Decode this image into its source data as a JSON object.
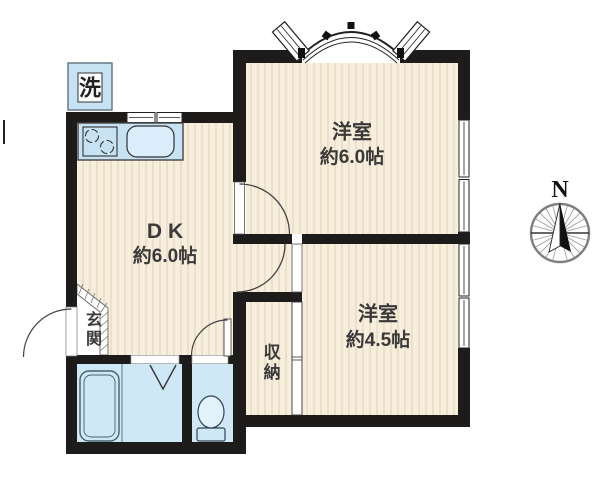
{
  "colors": {
    "wall": "#1e1c1a",
    "floor": "#f8eedd",
    "stripe": "#eadcc4",
    "water": "#cfe8f5",
    "fixture": "#c7e2f3",
    "ink": "#3a3a3a",
    "line": "#444444"
  },
  "rooms": {
    "western1": {
      "label": "洋室",
      "size": "約6.0帖"
    },
    "western2": {
      "label": "洋室",
      "size": "約4.5帖"
    },
    "dk": {
      "label": "DK",
      "size": "約6.0帖"
    },
    "storage": {
      "label": "収納"
    },
    "entrance": {
      "label": "玄関"
    }
  },
  "laundry": {
    "label": "洗"
  },
  "compass": {
    "north": "N"
  }
}
